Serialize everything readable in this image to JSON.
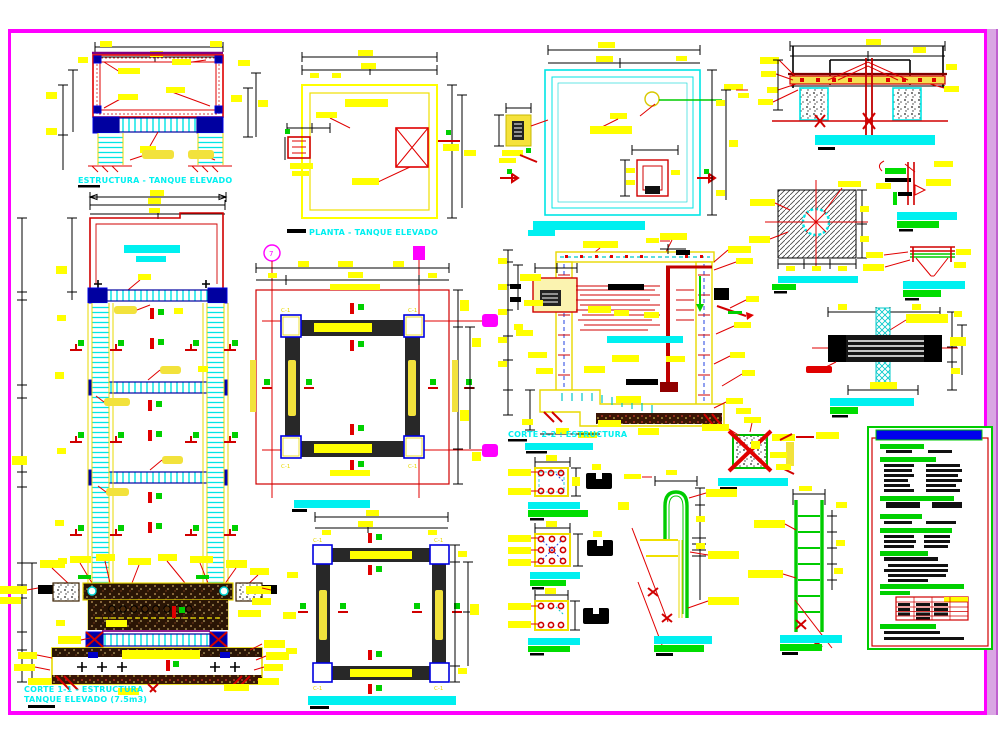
{
  "drawing": {
    "background": "#FFFFFF",
    "frame_color": "#FF00FF",
    "band_color": "#D9A6E3",
    "titles": {
      "estructura_tanque": "ESTRUCTURA - TANQUE ELEVADO",
      "planta_tanque": "PLANTA - TANQUE ELEVADO",
      "corte_22": "CORTE 2-2 : ESTRUCTURA",
      "corte_11_l1": "CORTE 1-1 - ESTRUCTURA",
      "corte_11_l2": "TANQUE ELEVADO (7.5m3)"
    },
    "grid": {
      "bubble_7": "7",
      "column_label": "C-1"
    },
    "colors": {
      "dimension_text": "#FFFF00",
      "structure_lines": "#E00000",
      "titles": "#00F0F0",
      "rebar_marks": "#00DD00",
      "beam_nodes": "#0000A0",
      "soil_hatch": "#2A1505",
      "spec_header_bars": "#00D000",
      "spec_title_bar": "#0000EE"
    }
  }
}
